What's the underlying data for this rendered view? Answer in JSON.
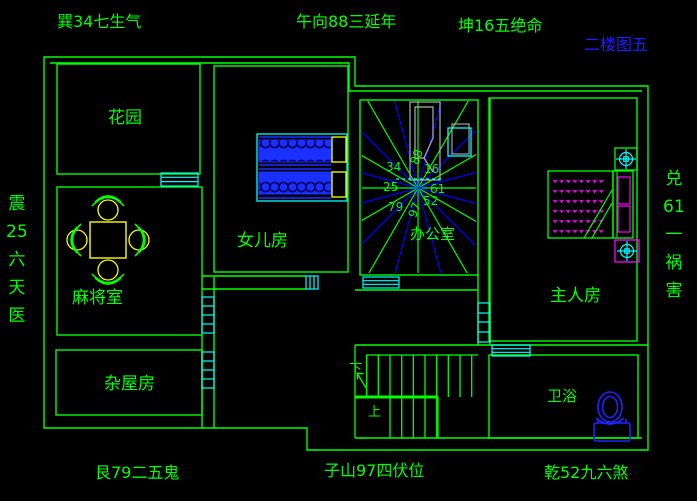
{
  "title": {
    "text": "二楼图五"
  },
  "compass": {
    "top_left": "巽34七生气",
    "top_center": "午向88三延年",
    "top_right": "坤16五绝命",
    "bottom_left": "艮79二五鬼",
    "bottom_center": "子山97四伏位",
    "bottom_right": "乾52九六煞",
    "left_vertical": [
      "震",
      "25",
      "六",
      "天",
      "医"
    ],
    "right_vertical": [
      "兑",
      "61",
      "一",
      "祸",
      "害"
    ]
  },
  "rooms": {
    "garden": "花园",
    "daughter": "女儿房",
    "office": "办公室",
    "mahjong": "麻将室",
    "master": "主人房",
    "storage": "杂屋房",
    "bathroom": "卫浴"
  },
  "stairs": {
    "down": "下",
    "up": "上"
  },
  "star_numbers": {
    "se": "34",
    "s": "88",
    "sw": "16",
    "e": "25",
    "w": "61",
    "ne": "79",
    "n": "97",
    "nw": "52"
  },
  "colors": {
    "background": "#000000",
    "wall_green": "#00ff00",
    "window_cyan": "#00ffff",
    "furniture_yellow": "#ffff00",
    "bed_blue": "#1a30ff",
    "magenta": "#ff00ff",
    "ray_blue": "#0000ff",
    "title_blue": "#1f1fff",
    "desk_gray": "#b0b0b0"
  }
}
